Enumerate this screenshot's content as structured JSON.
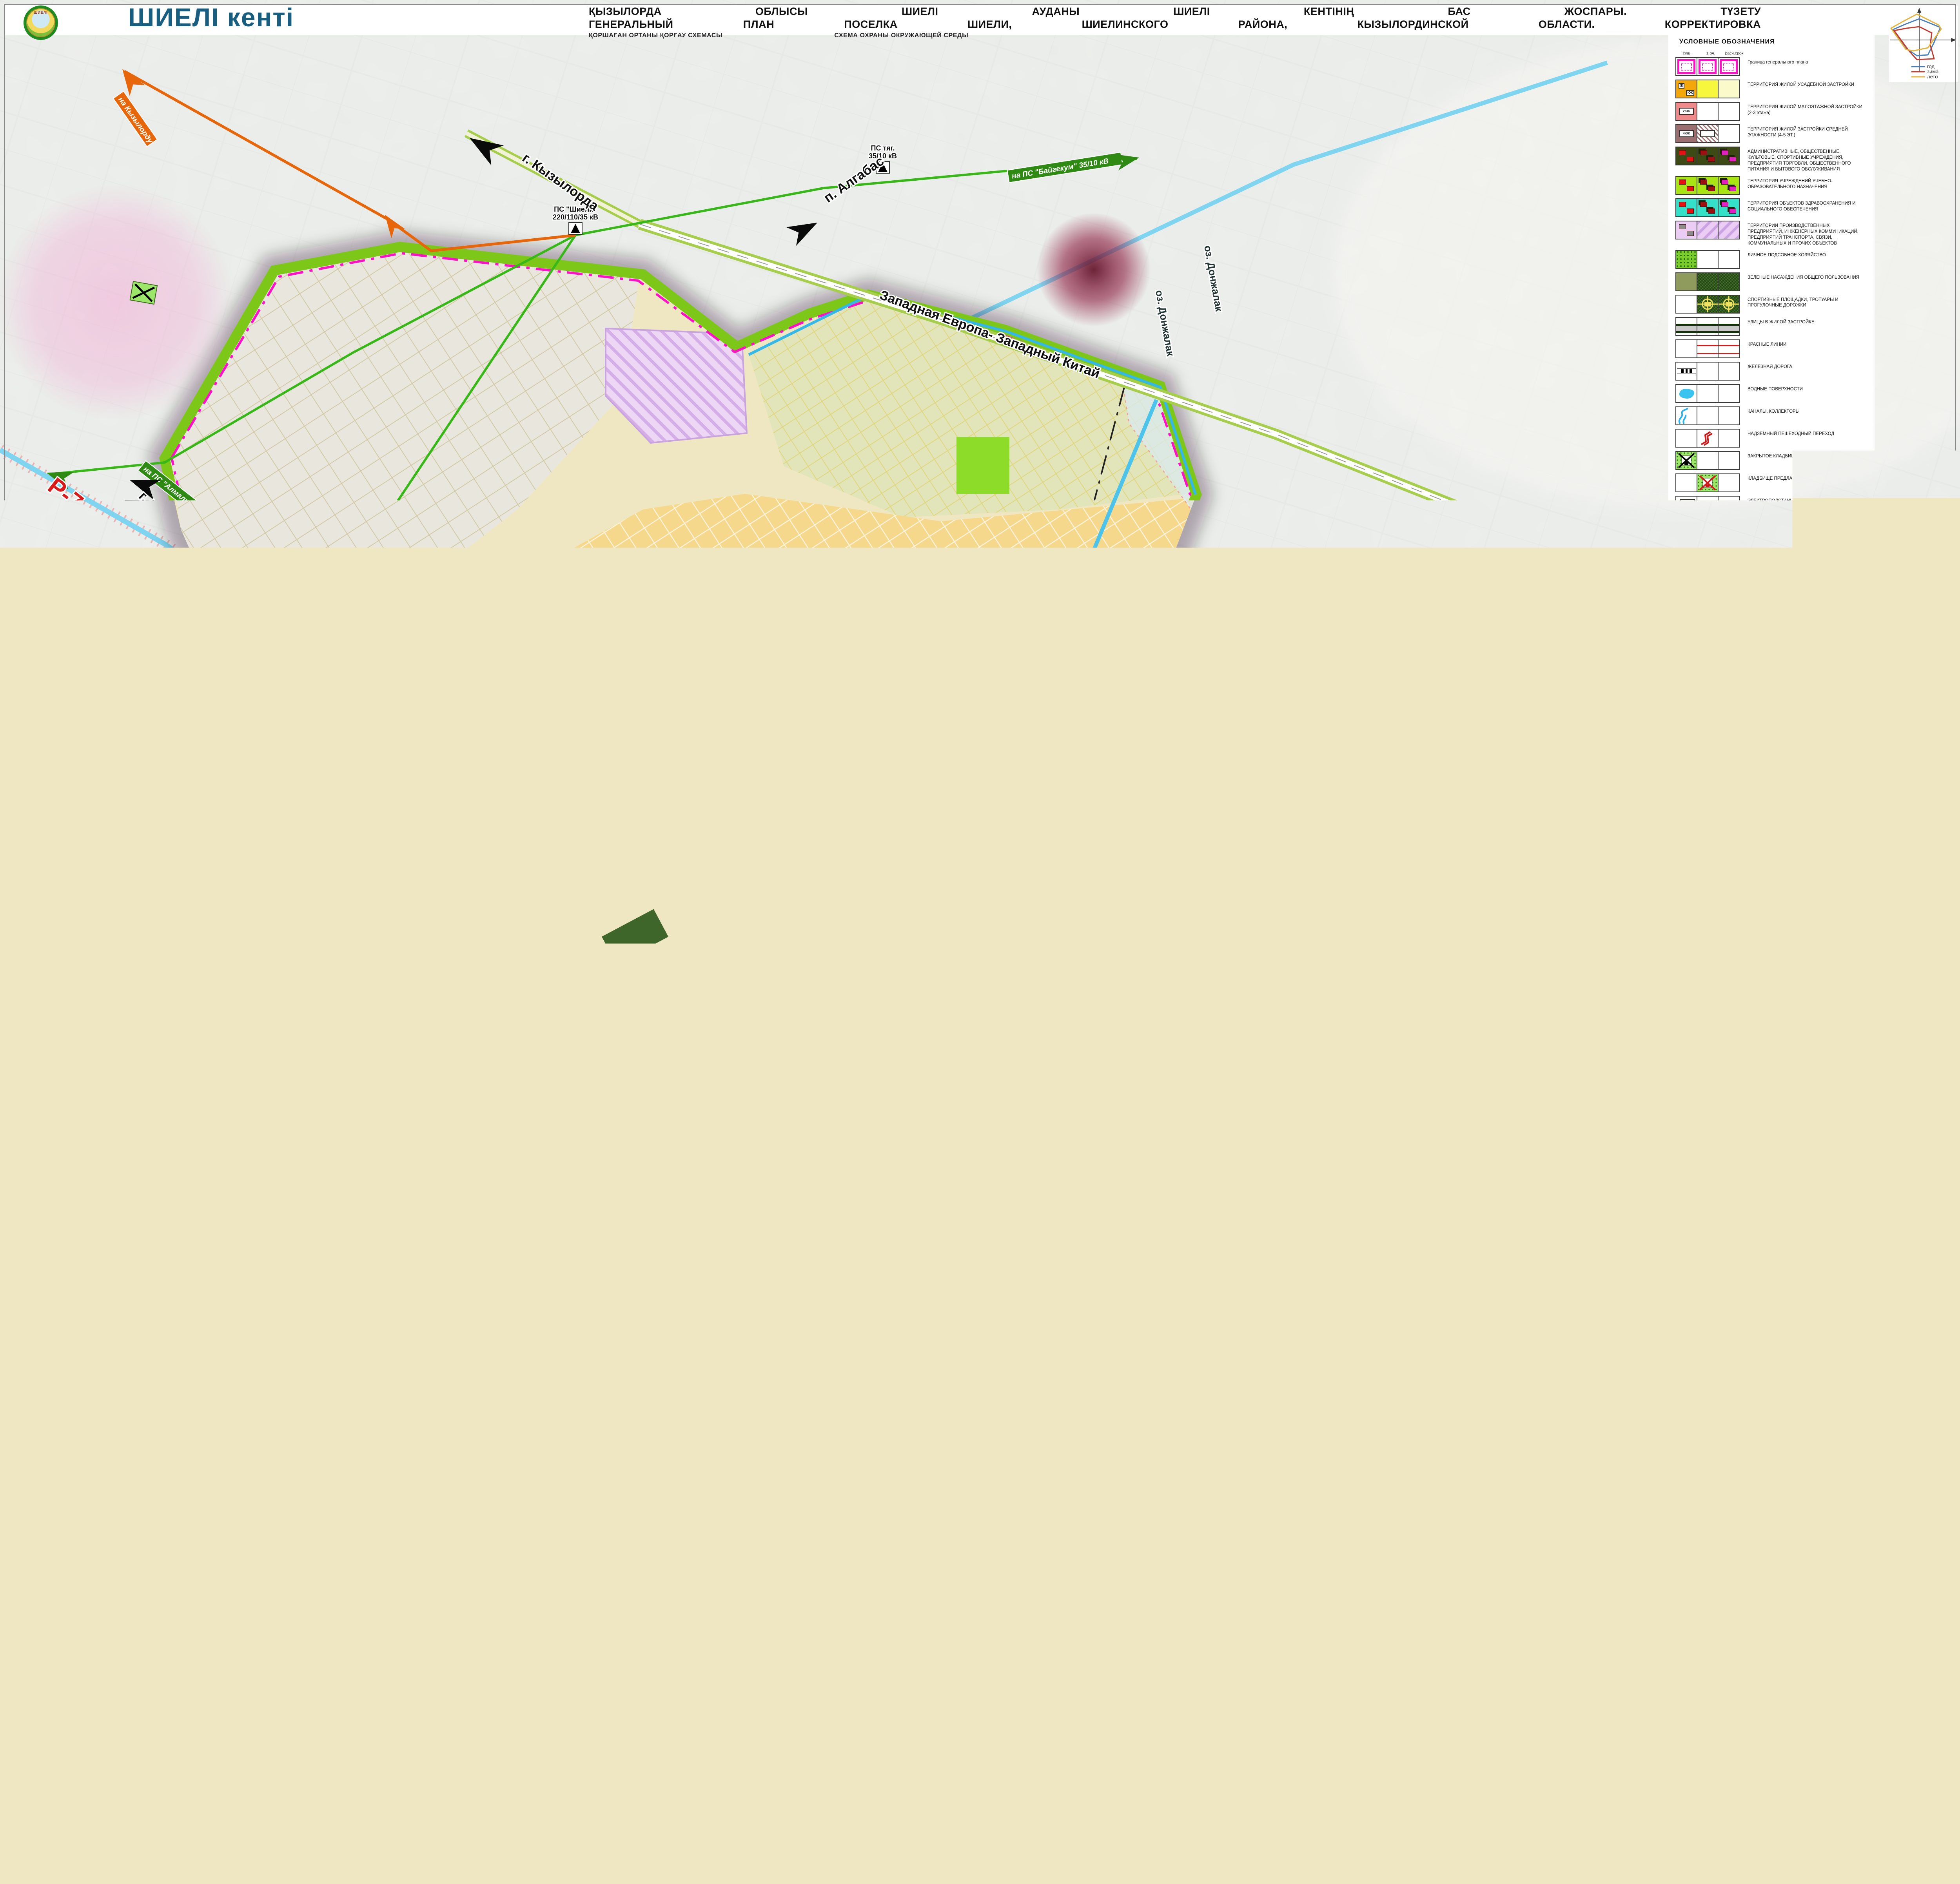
{
  "header": {
    "logo_text": "ШИЕЛІ",
    "big_title": "ШИЕЛІ кенті",
    "title_kz": "ҚЫЗЫЛОРДА ОБЛЫСЫ ШИЕЛІ АУДАНЫ ШИЕЛІ КЕНТІНІҢ БАС ЖОСПАРЫ. ТҮЗЕТУ",
    "title_ru": "ГЕНЕРАЛЬНЫЙ ПЛАН ПОСЕЛКА ШИЕЛИ, ШИЕЛИНСКОГО РАЙОНА, КЫЗЫЛОРДИНСКОЙ ОБЛАСТИ. КОРРЕКТИРОВКА",
    "subtitle_kz": "ҚОРШАҒАН ОРТАНЫ ҚОРҒАУ СХЕМАСЫ",
    "subtitle_ru": "СХЕМА ОХРАНЫ ОКРУЖАЮЩЕЙ СРЕДЫ"
  },
  "wind_rose": {
    "series": [
      {
        "label": "год",
        "color": "#4a7ebb"
      },
      {
        "label": "зима",
        "color": "#c23b2e"
      },
      {
        "label": "лето",
        "color": "#e5b33c"
      }
    ]
  },
  "legend": {
    "title": "УСЛОВНЫЕ ОБОЗНАЧЕНИЯ",
    "columns": [
      "сущ.",
      "1 оч.",
      "расч.срок"
    ],
    "groups": [
      {
        "heading": null,
        "items": [
          {
            "label": "Граница генерального плана",
            "cells": [
              "gp",
              "gp",
              "gp"
            ]
          },
          {
            "label": "ТЕРРИТОРИЯ ЖИЛОЙ УСАДЕБНОЙ ЗАСТРОЙКИ",
            "cells": [
              "usad:#F3A70B",
              "solid:#F7F73E",
              "solid:#FBFACB"
            ]
          },
          {
            "label": "ТЕРРИТОРИЯ ЖИЛОЙ МАЛОЭТАЖНОЙ ЗАСТРОЙКИ (2-3 этажа)",
            "cells": [
              "mal:#F08A8A:2ЮК",
              "",
              ""
            ]
          },
          {
            "label": "ТЕРРИТОРИЯ ЖИЛОЙ ЗАСТРОЙКИ СРЕДНЕЙ ЭТАЖНОСТИ (4-5 ЭТ.)",
            "cells": [
              "mal:#9B6F6F:4ЮК",
              "hdots:#9B6F6F",
              ""
            ]
          },
          {
            "label": "АДМИНИСТРАТИВНЫЕ, ОБЩЕСТВЕННЫЕ, КУЛЬТОВЫЕ, СПОРТИВНЫЕ УЧРЕЖДЕНИЯ, ПРЕДПРИЯТИЯ ТОРГОВЛИ, ОБЩЕСТВЕННОГО ПИТАНИЯ И БЫТОВОГО ОБСЛУЖИВАНИЯ",
            "cells": [
              "cubes:#3E4A16:#E81010:",
              "cubes:#3E4A16:#9E1010:d3",
              "cubes:#3E4A16:#E020C0:d3"
            ]
          },
          {
            "label": "ТЕРРИТОРИЯ УЧРЕЖДЕНИЙ УЧЕБНО-ОБРАЗОВАТЕЛЬНОГО НАЗНАЧЕНИЯ",
            "cells": [
              "cubes:#A9E414:#E81010:",
              "cubes:#A9E414:#9E1010:d3",
              "cubes:#A9E414:#E020C0:d3"
            ]
          },
          {
            "label": "ТЕРРИТОРИЯ ОБЪЕКТОВ ЗДРАВООХРАНЕНИЯ И СОЦИАЛЬНОГО ОБЕСПЕЧЕНИЯ",
            "cells": [
              "cubes:#35E0C8:#E81010:",
              "cubes:#35E0C8:#9E1010:d3",
              "cubes:#35E0C8:#E020C0:d3"
            ]
          },
          {
            "label": "ТЕРРИТОРИИ ПРОИЗВОДСТВЕННЫХ ПРЕДПРИЯТИЙ, ИНЖЕНЕРНЫХ КОММУНИКАЦИЙ, ПРЕДПРИЯТИЙ ТРАНСПОРТА, СВЯЗИ, КОММУНАЛЬНЫХ И ПРОЧИХ ОБЪЕКТОВ",
            "cells": [
              "cubes:#EACCF4:#8C8C8C:",
              "hatch:#EACCF4:#CBA3E2",
              "hatch:#EACCF4:#CBA3E2"
            ]
          },
          {
            "label": "ЛИЧНОЕ ПОДСОБНОЕ ХОЗЯЙСТВО",
            "cells": [
              "grass:#7ACC29",
              "",
              ""
            ]
          },
          {
            "label": "ЗЕЛЕНЫЕ НАСАЖДЕНИЯ ОБЩЕГО ПОЛЬЗОВАНИЯ",
            "cells": [
              "solid:#8E9B5C",
              "tex:#2E5C17",
              "tex:#2E5C17"
            ]
          },
          {
            "label": "СПОРТИВНЫЕ ПЛОЩАДКИ, ТРОТУАРЫ И ПРОГУЛОЧНЫЕ ДОРОЖКИ",
            "cells": [
              "",
              "sport",
              "sport"
            ]
          },
          {
            "label": "УЛИЦЫ В ЖИЛОЙ ЗАСТРОЙКЕ",
            "cells": [
              "street",
              "street",
              "street"
            ]
          },
          {
            "label": "КРАСНЫЕ ЛИНИИ",
            "cells": [
              "",
              "redl",
              "redl"
            ]
          },
          {
            "label": "ЖЕЛЕЗНАЯ ДОРОГА",
            "cells": [
              "rail",
              "",
              ""
            ]
          },
          {
            "label": "ВОДНЫЕ ПОВЕРХНОСТИ",
            "cells": [
              "water",
              "",
              ""
            ]
          },
          {
            "label": "КАНАЛЫ, КОЛЛЕКТОРЫ",
            "cells": [
              "canal",
              "",
              ""
            ]
          },
          {
            "label": "НАДЗЕМНЫЙ ПЕШЕХОДНЫЙ ПЕРЕХОД",
            "cells": [
              "",
              "pedx",
              ""
            ]
          },
          {
            "label": "ЗАКРЫТОЕ КЛАДБИЩЕ",
            "cells": [
              "cemx:#000000",
              "",
              ""
            ]
          },
          {
            "label": "КЛАДБИЩЕ ПРЕДЛАГАЕМОЕ К ЗАКРЫТИЮ",
            "cells": [
              "",
              "cemx:#d01818",
              ""
            ]
          },
          {
            "label": "ЭЛЕКТРОПОДСТАНЦИЯ",
            "cells": [
              "tribox:#000000",
              "",
              ""
            ]
          },
          {
            "label": "ТРАНСФОРМАТОРНАЯ ПОДСТАНЦИЯ",
            "cells": [
              "circ:#7A1FA8",
              "",
              ""
            ]
          },
          {
            "label": "АВТОМАТИЧЕСКАЯ ТЕЛЕФОННАЯ СТАНЦИЯ",
            "cells": [
              "tri:#F020C0",
              "",
              ""
            ]
          },
          {
            "label": "ЛИНИИ ЭЛЕКТРОПЕРЕДАЧИ 220 кВ",
            "cells": [
              "lep:#E8660A:220кВ",
              "",
              ""
            ]
          },
          {
            "label": "ЛИНИИ ЭЛЕКТРОПЕРЕДАЧИ 110 кВ",
            "cells": [
              "lep:#111111:110кВ",
              "",
              ""
            ]
          },
          {
            "label": "ЛИНИИ ЭЛЕКТРОПЕРЕДАЧИ 35 кВ",
            "cells": [
              "lep:#38B818:35кВ",
              "",
              ""
            ]
          },
          {
            "label": "РАЙОННЫЙ АКИМАТ",
            "cells": [
              "star:#F020C0",
              "",
              ""
            ]
          },
          {
            "label": "ЖЕЛЕЗНОДОРОЖНЫЙ ВОКЗАЛ",
            "cells": [
              "train:#2838C8",
              "",
              ""
            ]
          },
          {
            "label": "ПАМЯТНИК",
            "cells": [
              "monument:#F06018",
              "",
              ""
            ]
          },
          {
            "label": "ПЛОЩАДКА ВОДОПРОВОДНЫХ ОЧИСТНЫХ СООРУЖЕНИЙ",
            "cells": [
              "vos:ВОС",
              "",
              ""
            ]
          },
          {
            "label": "СИБИРЕЯЗВЕННЫЕ ЗАХОРОНЕНИЕ",
            "cells": [
              "bio:☣",
              "",
              ""
            ]
          },
          {
            "label": "СКОТОМОГИЛЬНИК",
            "cells": [
              "cow:#000000",
              "",
              ""
            ]
          }
        ]
      },
      {
        "heading": "ТЕРРИТОРИИ САНИТАРНО-ЗАЩИТНЫХ ЗОН",
        "items": [
          {
            "label": "САНИТАРНО-ЗАЩИТНАЯ ЗОНА ОТ КЛАДБИЩА",
            "cells": [
              "dotb:#9CE614",
              "szzcem:#7A8A4A",
              ""
            ]
          },
          {
            "label": "САНИТАРНО-ЗАЩИТНАЯ ЗОНА ОТ ЖЕЛЕЗНОЙ ДОРОГИ",
            "cells": [
              "solid:#CBD6DB",
              "",
              ""
            ]
          },
          {
            "label": "САНИТАРНО-ЗАЩИТНАЯ ЗОНА ОТ ПРОИЗВОДСТВЕННЫХ ПРЕДПРИЯТИЙ",
            "cells": [
              "szzind:#A8285C",
              "hatchb:#E8F8D4:#4E7A1E:#35E014",
              "hatchb:#E8F8D4:#4E7A1E:#35E014"
            ]
          },
          {
            "label": "САНИТАРНО-ЗАЩИТНАЯ ЗОНА ОТ СИБИРЕЯЗВЕННОГО ЗАХОРОНЕНИЯ",
            "cells": [
              "grad:#F8B8E4:#E818A8",
              "",
              ""
            ]
          },
          {
            "label": "САНИТАРНО-ЗАЩИТНАЯ ЗОНА ОТ СКОТОМОГИЛЬНИКА",
            "cells": [
              "grad:#5A3A14:#CBB286",
              "",
              ""
            ]
          }
        ]
      },
      {
        "heading": "ТЕРРИТОРИИ ЗОН САНИТАРНОЙ ОХРАНЫ",
        "items": [
          {
            "label": "ПРИДОРОЖНАЯ ПОЛОСА",
            "cells": [
              "hatch:#EEF2A0:#C2CC30:#CCD818",
              "",
              ""
            ]
          },
          {
            "label": "ЗОНА ОХРАНЫ ОТ ЛИНИЙ ЭЛЕКТРОПЕРЕДАЧИ",
            "cells": [
              "solid:#E4F4B4",
              "",
              ""
            ]
          },
          {
            "label": "ВОДООХРАННАЯ ПОЛОСА",
            "cells": [
              "hatchd:#D03030",
              "",
              ""
            ]
          },
          {
            "label": "ВОДООХРАННАЯ ЗОНА",
            "cells": [
              "hatchd:#28B8D8",
              "",
              ""
            ]
          }
        ]
      }
    ]
  },
  "map": {
    "labels": [
      {
        "text": "г. Кызылорда",
        "x": 1330,
        "y": 408,
        "rot": 35,
        "cls": "place"
      },
      {
        "text": "п. Алгабас",
        "x": 2112,
        "y": 518,
        "rot": -35,
        "cls": "place"
      },
      {
        "text": "Западная Европа- Западный Китай",
        "x": 2242,
        "y": 762,
        "rot": 20,
        "cls": "road"
      },
      {
        "text": "Р-7",
        "x": 118,
        "y": 1248,
        "rot": 38,
        "cls": "route"
      },
      {
        "text": "г. Кызылорда",
        "x": 352,
        "y": 1268,
        "rot": 46,
        "cls": "place"
      },
      {
        "text": "п. Жанакорган",
        "x": 4046,
        "y": 1562,
        "rot": 31,
        "cls": "place"
      },
      {
        "text": "оз. Донжалак",
        "x": 3072,
        "y": 628,
        "rot": 80,
        "cls": "water"
      },
      {
        "text": "оз. Донжалак",
        "x": 2948,
        "y": 742,
        "rot": 80,
        "cls": "water"
      },
      {
        "text": "С. Жахаев",
        "x": 664,
        "y": 2438,
        "rot": -72,
        "cls": "place"
      },
      {
        "text": "С. Бидайколь",
        "x": 988,
        "y": 3446,
        "rot": -78,
        "cls": "place"
      },
      {
        "text": "С. Кодаманова",
        "x": 4580,
        "y": 3248,
        "rot": -62,
        "cls": "place"
      },
      {
        "text": "Новошиелийский МК",
        "x": 3636,
        "y": 4442,
        "rot": 78,
        "cls": "canal"
      },
      {
        "text": "на сельхоз. поля",
        "x": 3192,
        "y": 4392,
        "rot": 78,
        "cls": "place"
      },
      {
        "text": "п. Жанакорган",
        "x": 4548,
        "y": 4348,
        "rot": 54,
        "cls": "place"
      },
      {
        "text": "С. Акмая",
        "x": 4574,
        "y": 4438,
        "rot": 54,
        "cls": "place"
      },
      {
        "text": "Л-1",
        "x": 3502,
        "y": 4396,
        "rot": 54,
        "cls": "code"
      },
      {
        "text": "Р-1",
        "x": 3558,
        "y": 4548,
        "rot": 54,
        "cls": "code"
      }
    ],
    "ribbons": [
      {
        "text": "на ПС \"Алмалы\" 35/10 кВ",
        "x": 362,
        "y": 1188,
        "rot": 38,
        "color": "#2e8a12"
      },
      {
        "text": "на ПС \"Ортакшыл\" 35/10 кВ",
        "x": 248,
        "y": 1362,
        "rot": 38,
        "color": "#2e8a12"
      },
      {
        "text": "на ПС \"Байгекум\" 35/10 кВ",
        "x": 2572,
        "y": 450,
        "rot": -9,
        "color": "#2e8a12"
      },
      {
        "text": "на Кызылорду",
        "x": 302,
        "y": 242,
        "rot": 55,
        "color": "#e8660a"
      }
    ],
    "arrows": [
      {
        "x": 1198,
        "y": 352,
        "rot": -148,
        "color": "#0a0a0a",
        "s": 1
      },
      {
        "x": 2085,
        "y": 568,
        "rot": -28,
        "color": "#0a0a0a",
        "s": 0.9
      },
      {
        "x": 330,
        "y": 1224,
        "rot": -160,
        "color": "#0a0a0a",
        "s": 0.9
      },
      {
        "x": 318,
        "y": 1276,
        "rot": -160,
        "color": "#0a0a0a",
        "s": 0.7
      },
      {
        "x": 4352,
        "y": 1604,
        "rot": 22,
        "color": "#0a0a0a",
        "s": 1
      },
      {
        "x": 3212,
        "y": 4590,
        "rot": 118,
        "color": "#0a0a0a",
        "s": 0.9
      },
      {
        "x": 4652,
        "y": 4512,
        "rot": 38,
        "color": "#0a0a0a",
        "s": 1
      },
      {
        "x": 4764,
        "y": 4584,
        "rot": 38,
        "color": "#0a0a0a",
        "s": 0.8
      },
      {
        "x": 118,
        "y": 1206,
        "rot": -162,
        "color": "#2e8a12",
        "s": 0.8
      },
      {
        "x": 692,
        "y": 1566,
        "rot": 160,
        "color": "#2e8a12",
        "s": 0.8
      },
      {
        "x": 2906,
        "y": 402,
        "rot": -12,
        "color": "#2e8a12",
        "s": 0.7
      },
      {
        "x": 312,
        "y": 176,
        "rot": -125,
        "color": "#e8660a",
        "s": 0.8
      },
      {
        "x": 982,
        "y": 548,
        "rot": -125,
        "color": "#e8660a",
        "s": 0.7
      }
    ],
    "substations": [
      {
        "name": "ПС \"Шиели\"",
        "volt": "220/110/35 кВ",
        "x": 1468,
        "y": 540
      },
      {
        "name": "ПС тяг.",
        "volt": "35/10 кВ",
        "x": 2252,
        "y": 384
      }
    ],
    "scale": {
      "title": "МАСШТАБ 1:5000",
      "subtitle": "В 1 САНТИМЕТРЕ 50 МЕТРОВ",
      "ticks": [
        "0",
        "50",
        "100",
        "200",
        "300",
        "400",
        "500"
      ],
      "unit": "М"
    }
  },
  "title_block": {
    "line1": "ҚЫЗЫЛОРДА ОБЛЫСЫ, ШИЕЛІ АУДАНЫ, ШИЕЛІ КЕНТІНІҢ БАС ЖОСПАРЫ",
    "line2": "ГЕНЕРАЛЬНЫЙ ПЛАН ПОСЕЛКА ШИЕЛИ, ШИЕЛИНСКОГО РАЙОНА, КЫЗЫЛОРДИНСКОЙ ОБЛАСТИ",
    "codes": [
      {
        "label": "ҚОРШАҒАН ОРТАНЫ ҚОРҒАУ СХЕМАСЫ",
        "code": "БЖ-10"
      },
      {
        "label": "СХЕМА ОХРАНЫ ОКРУЖАЮЩЕЙ СРЕДЫ",
        "code": "ГП-10"
      }
    ],
    "institute": "ТОО КАЗАХСТАНСКИЙ ПРОЕКТНО-ИССЛЕДОВАТЕЛЬСКИЙ ИНСТИТУТ «КАЗАХСТАНПРОЕКТ»",
    "emblem_letter": "К",
    "director_row": {
      "role": "Генеральный директор",
      "name": "Яковенко К.В."
    },
    "brand": "KAZGIPROGRAD 1",
    "roles": [
      {
        "role": "Директор института",
        "name": "Темербаев И.К."
      },
      {
        "role": "Главный архитектор проекта",
        "name": "Боранбай О.Т."
      },
      {
        "role": "Архитектор",
        "name": "Окас Е.Е."
      },
      {
        "role": "Главный специалист - эколог",
        "name": "Заридзе Ж.Г."
      }
    ],
    "city_year": "АЛМАТЫ 2024"
  }
}
